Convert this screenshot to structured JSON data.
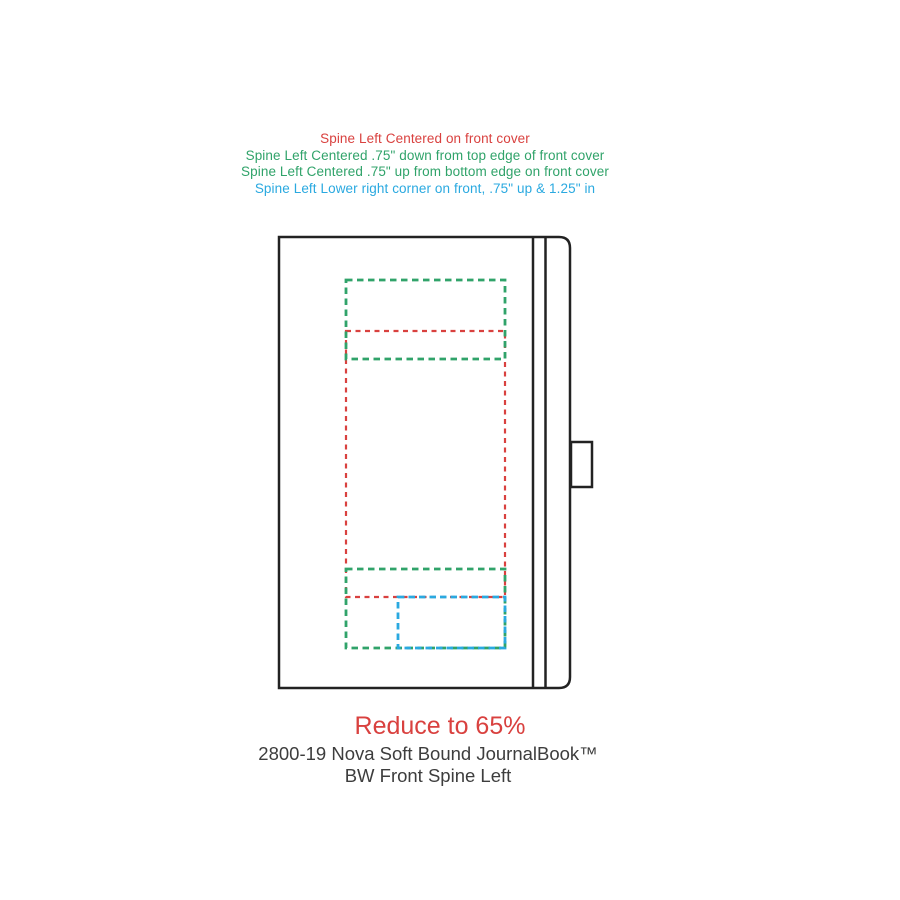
{
  "colors": {
    "red": "#d9413f",
    "green": "#30a36a",
    "blue": "#2aa9e0",
    "outline": "#222222",
    "text": "#3d3d3d"
  },
  "annotations": {
    "lines": [
      {
        "label": "Spine Left Centered on front cover",
        "color": "red"
      },
      {
        "label": "Spine Left Centered .75\" down from top edge of front cover",
        "color": "green"
      },
      {
        "label": "Spine Left Centered .75\" up from bottom edge on front cover",
        "color": "green"
      },
      {
        "label": "Spine Left Lower right corner on front, .75\" up & 1.25\" in",
        "color": "blue"
      }
    ]
  },
  "footer": {
    "reduce_note": "Reduce to 65%",
    "product_line1": "2800-19 Nova Soft Bound JournalBook™",
    "product_line2": "BW Front Spine Left"
  }
}
